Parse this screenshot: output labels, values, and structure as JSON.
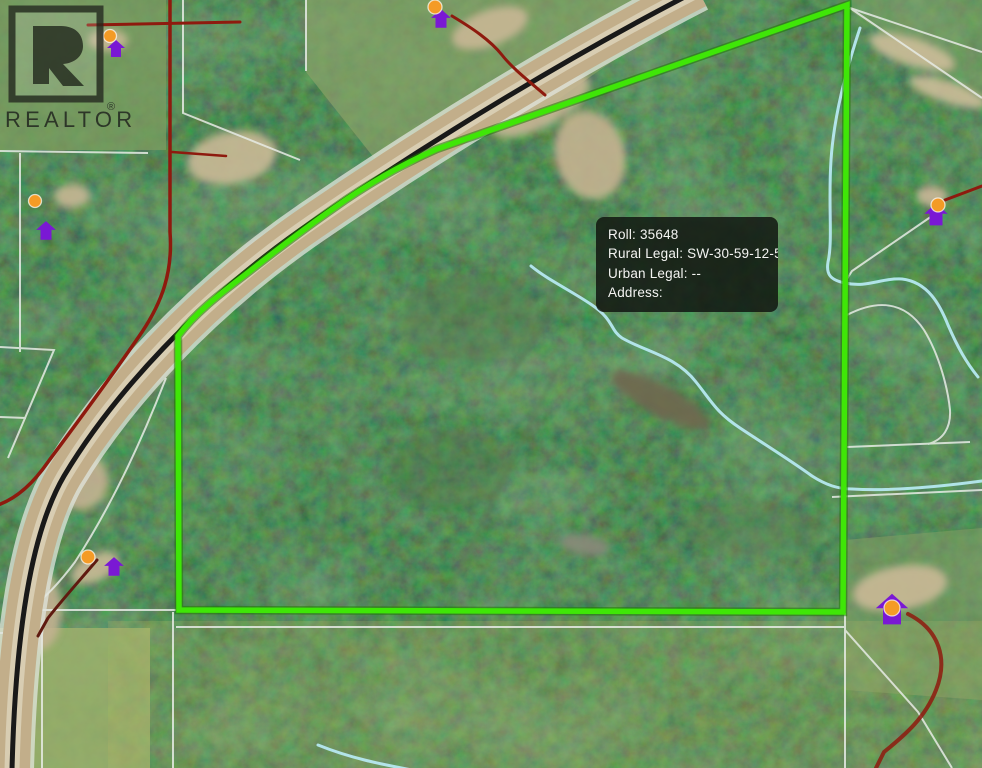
{
  "window": {
    "width": 982,
    "height": 768,
    "type": "satellite-map-view"
  },
  "branding": {
    "logo_text": "REALTOR",
    "registered_symbol": "®"
  },
  "tooltip": {
    "lines": [
      "Roll: 35648",
      "Rural Legal: SW-30-59-12-5",
      "Urban Legal: --",
      "Address:"
    ],
    "fields": {
      "roll": "35648",
      "rural_legal": "SW-30-59-12-5",
      "urban_legal": "--",
      "address": ""
    }
  },
  "colors": {
    "boundary": "#3fe607",
    "boundary_shadow": "#1f7a02",
    "creek": "#b6e8f0",
    "road_black": "#191919",
    "road_tan": "#c2ae8a",
    "road_pale": "#d8cdb2",
    "road_red": "#8e1a0e",
    "parcel_line": "#e7ebe5",
    "marker_house": "#7a18d4",
    "marker_dot": "#f49b26",
    "tooltip_bg": "rgba(16,20,15,0.84)",
    "tooltip_fg": "#f4f4f2",
    "logo_ink": "#23271f",
    "forest_base": "#2c452e"
  },
  "map": {
    "boundary": {
      "shape": "polygon",
      "vertices_px": [
        [
          847,
          5
        ],
        [
          843,
          612
        ],
        [
          179,
          610
        ],
        [
          178,
          336
        ],
        [
          246,
          274
        ],
        [
          334,
          208
        ],
        [
          437,
          149
        ]
      ],
      "note": "kink at 178,336 curves along highway up to 437,149 then straight to 847,5"
    },
    "markers": [
      {
        "dot": [
          110,
          36
        ],
        "house": [
          116,
          49
        ],
        "scale": 1.0,
        "dot_r": 6.5
      },
      {
        "dot": [
          435,
          7
        ],
        "house": [
          441,
          19
        ],
        "scale": 1.1,
        "dot_r": 7
      },
      {
        "dot": [
          35,
          201
        ],
        "house": [
          46,
          231
        ],
        "scale": 1.1,
        "dot_r": 6.5
      },
      {
        "dot": [
          88,
          557
        ],
        "house": [
          114,
          567
        ],
        "scale": 1.1,
        "dot_r": 7
      },
      {
        "dot": [
          938,
          205
        ],
        "house": [
          936,
          215
        ],
        "scale": 1.3,
        "dot_r": 7
      },
      {
        "dot": [
          892,
          608
        ],
        "house": [
          892,
          610
        ],
        "scale": 1.8,
        "dot_r": 8
      }
    ]
  }
}
